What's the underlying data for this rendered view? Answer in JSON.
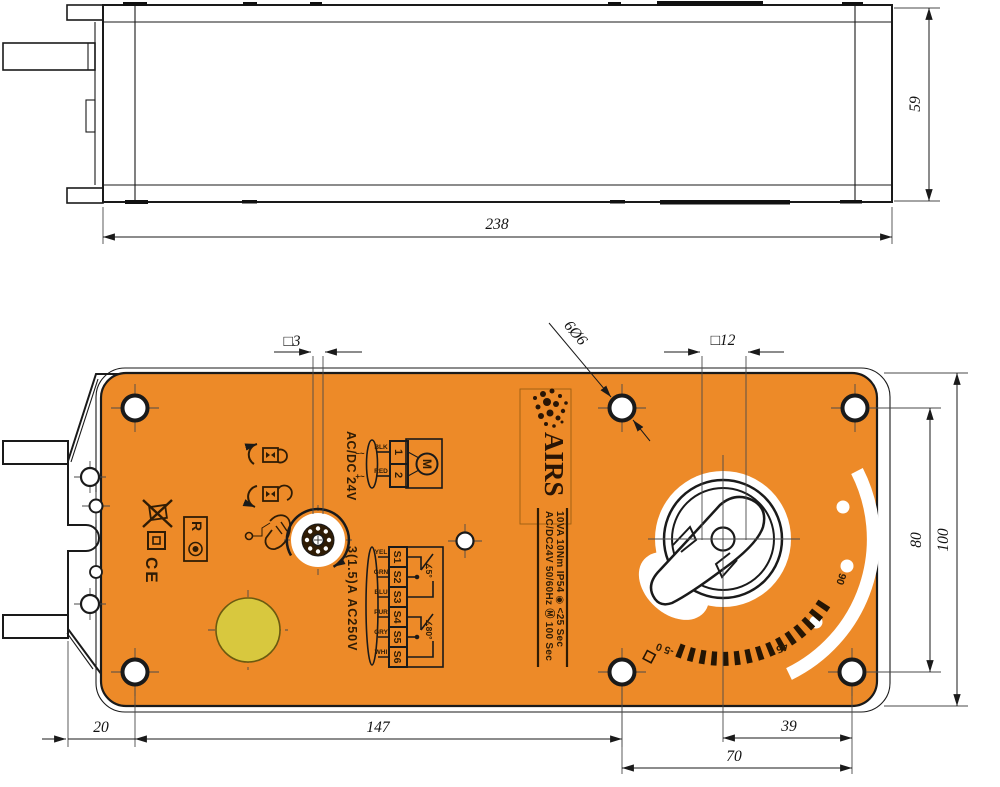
{
  "colors": {
    "body_orange": "#ED8A28",
    "line_dark": "#1A1A1A",
    "print_dark": "#2F1C05",
    "yellow_cap": "#D8C83E",
    "paper": "#FFFFFF"
  },
  "top_view": {
    "width_dim": "238",
    "height_dim": "59"
  },
  "front_view": {
    "dims": {
      "shaft_square": "□3",
      "mount_holes": "6Ø6",
      "shaft_head_square": "□12",
      "hole_pitch_vertical": "80",
      "body_height": "100",
      "bracket_offset": "20",
      "hole_pitch_horizontal": "147",
      "dial_to_hole": "39",
      "hole_pitch_right": "70"
    },
    "logo": {
      "brand": "AIRS"
    },
    "nameplate": {
      "line1": "AC/DC24V  50/60Hz  Ⓜ 100 Sec",
      "line2": "10VA  10Nm  IP54  ◉ <25 Sec"
    },
    "power_wiring": {
      "title": "AC/DC 24V",
      "minus_mark": "–~",
      "plus_mark": "+~",
      "wire_black": "BLK",
      "wire_red": "RED",
      "terminal_1": "1",
      "terminal_2": "2",
      "motor": "M"
    },
    "aux_switch": {
      "rating": "3(1.5)A AC250V",
      "wires": [
        "YEL",
        "GRN",
        "BLU",
        "PUR",
        "GRY",
        "WHI"
      ],
      "terminals": [
        "S1",
        "S2",
        "S3",
        "S4",
        "S5",
        "S6"
      ],
      "switch1_angle": "∡5°",
      "switch2_angle": "∡80°"
    },
    "marks": {
      "ce_mark": "CE",
      "reset_label": "R"
    },
    "dial_scale": {
      "start_label": "-5 0",
      "mid_label": "45",
      "end_label": "90"
    }
  }
}
